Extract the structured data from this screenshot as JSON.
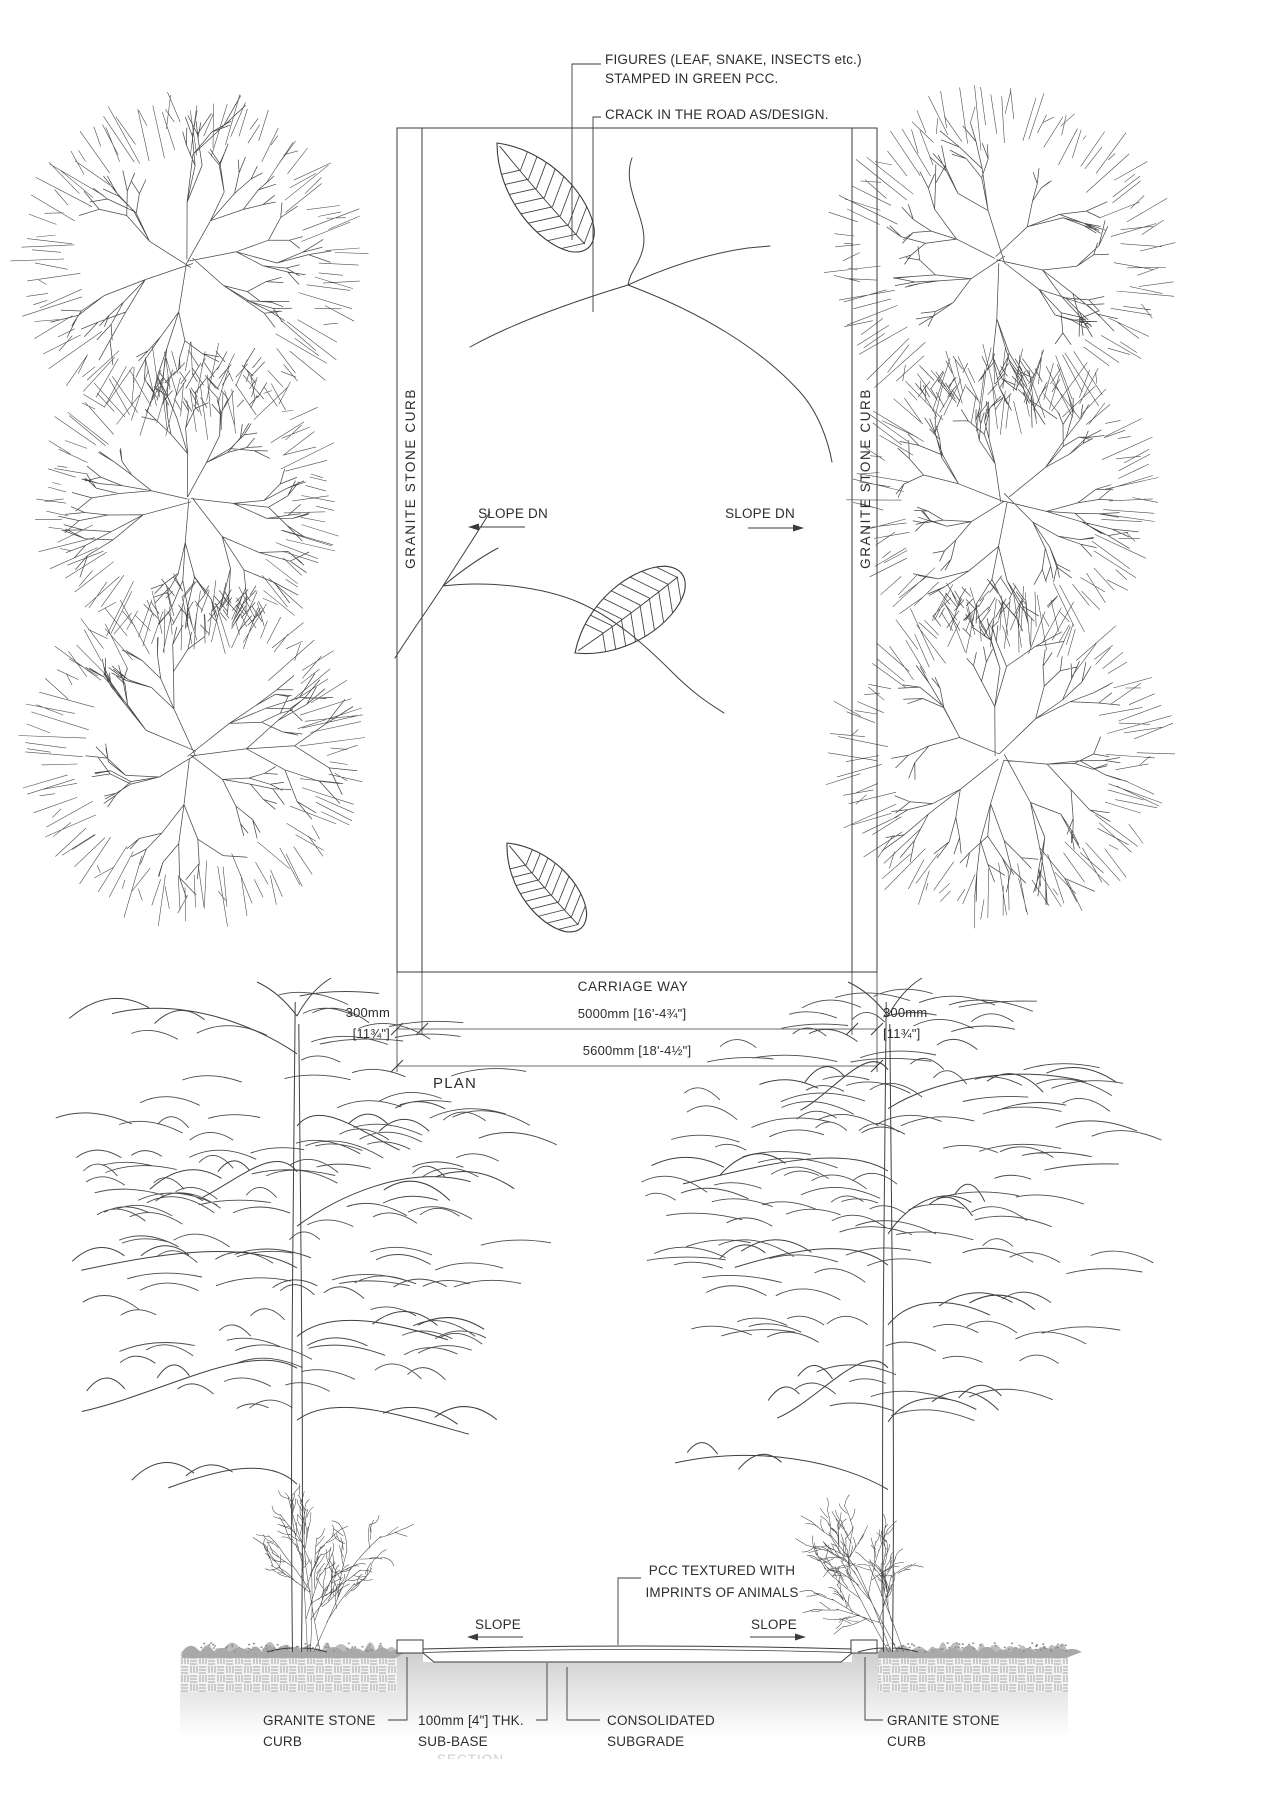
{
  "drawing": {
    "plan": {
      "title": "PLAN",
      "callout_figures_line1": "FIGURES (LEAF, SNAKE, INSECTS etc.)",
      "callout_figures_line2": "STAMPED IN GREEN PCC.",
      "callout_crack": "CRACK IN THE ROAD AS/DESIGN.",
      "curb_label_left": "GRANITE STONE CURB",
      "curb_label_right": "GRANITE STONE CURB",
      "slope_label_left": "SLOPE DN",
      "slope_label_right": "SLOPE DN",
      "carriage_way_label": "CARRIAGE WAY",
      "dim_carriage_width": "5000mm [16'-4¾\"]",
      "dim_total_width": "5600mm [18'-4½\"]",
      "dim_curb_left_line1": "300mm",
      "dim_curb_left_line2": "[11¾\"]",
      "dim_curb_right_line1": "300mm",
      "dim_curb_right_line2": "[11¾\"]"
    },
    "section": {
      "title": "SECTION",
      "callout_pcc_line1": "PCC TEXTURED WITH",
      "callout_pcc_line2": "IMPRINTS OF ANIMALS",
      "slope_label_left": "SLOPE",
      "slope_label_right": "SLOPE",
      "label_curb_left_line1": "GRANITE STONE",
      "label_curb_left_line2": "CURB",
      "label_subbase_line1": "100mm [4\"] THK.",
      "label_subbase_line2": "SUB-BASE",
      "label_subgrade_line1": "CONSOLIDATED",
      "label_subgrade_line2": "SUBGRADE",
      "label_curb_right_line1": "GRANITE STONE",
      "label_curb_right_line2": "CURB"
    },
    "colors": {
      "line": "#3b3b3b",
      "text": "#2d2d2d",
      "grass": "#b4b4b4",
      "hatch": "#a6a6a6",
      "subgrade_top": "#cfcfcf",
      "faded_title": "#cfcfcf"
    }
  }
}
